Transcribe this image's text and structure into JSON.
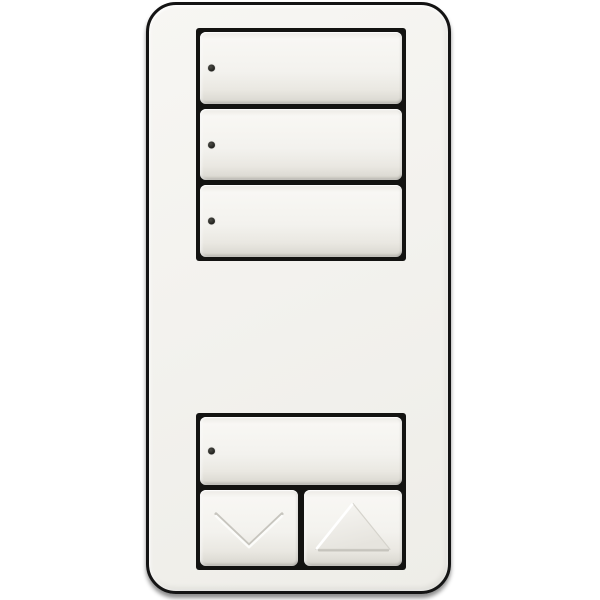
{
  "device": {
    "type": "wall-scene-keypad-dimmer",
    "button_count": 6
  },
  "colors": {
    "background": "#ffffff",
    "plate": "#f3f2ee",
    "plate_outline": "#141414",
    "well": "#131311",
    "button_face": "#f3f2ee",
    "button_edge": "#d2d0c8",
    "led": "#23231f"
  },
  "top_group": {
    "buttons": [
      {
        "name": "scene-button-1",
        "led_indicator": true,
        "label": ""
      },
      {
        "name": "scene-button-2",
        "led_indicator": true,
        "label": ""
      },
      {
        "name": "scene-button-3",
        "led_indicator": true,
        "label": ""
      }
    ]
  },
  "bottom_group": {
    "main_button": {
      "name": "scene-button-4",
      "led_indicator": true,
      "label": ""
    },
    "lower_button": {
      "name": "lower-button",
      "icon": "chevron-down-icon"
    },
    "raise_button": {
      "name": "raise-button",
      "icon": "chevron-up-icon"
    }
  }
}
